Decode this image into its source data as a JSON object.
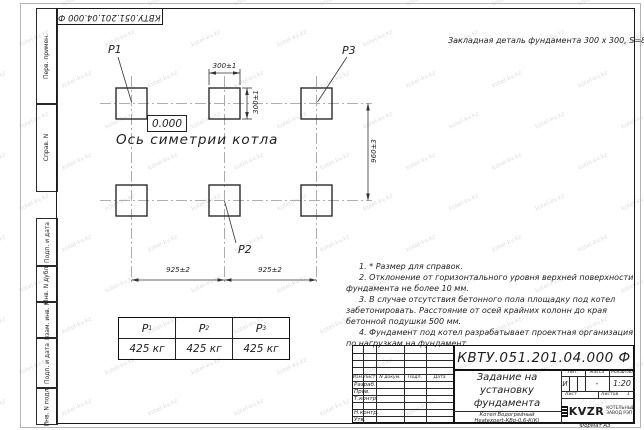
{
  "watermark": {
    "text": "kotel-kv.kz"
  },
  "stamp_top": {
    "designation": "КВТУ.051.201.04.000  Ф"
  },
  "top_note": "Закладная деталь фундамента  300 x 300,  S=8;",
  "drawing": {
    "elevation": "0.000",
    "axis_label": "Ось симетрии котла",
    "point_labels": {
      "p1": "P1",
      "p2": "P2",
      "p3": "P3"
    },
    "dims": {
      "width_top": "300±1",
      "height_side": "300±1",
      "row_spacing": "960±3",
      "col_spacing_left": "925±2",
      "col_spacing_right": "925±2"
    }
  },
  "notes": [
    "1. * Размер для справок.",
    "2. Отклонение от горизонтального уровня верхней поверхности фундамента не более 10 мм.",
    "3. В случае отсутствия бетонного пола площадку под котел забетонировать. Расстояние от осей крайних колонн до края бетонной подушки 500 мм.",
    "4. Фундамент под котел разрабатывает проектная организация по нагрузкам на фундамент."
  ],
  "load_table": {
    "columns": [
      {
        "label": "P",
        "sub": "1",
        "value": "425 кг"
      },
      {
        "label": "P",
        "sub": "2",
        "value": "425 кг"
      },
      {
        "label": "P",
        "sub": "3",
        "value": "425 кг"
      }
    ]
  },
  "sidebar": {
    "labels": [
      "Перв. примен.",
      "Справ. N",
      "Подп. и дата",
      "Инв. N дубл.",
      "Взам. инв. N",
      "Подп. и дата",
      "Инв. N подл."
    ]
  },
  "title_block": {
    "designation": "КВТУ.051.201.04.000  Ф",
    "title": "Задание на установку фундамента",
    "doc_header": {
      "izm": "Изм.",
      "list": "Лист",
      "ndoc": "N докум.",
      "podp": "Подп.",
      "data": "Дата"
    },
    "sign_rows": [
      "Разраб.",
      "Пров.",
      "Т.контр.",
      "",
      "Н.контр.",
      "Утв."
    ],
    "lit_header": "Лит.",
    "lit_value": "И",
    "mass_header": "Масса",
    "mass_value": "-",
    "scale_header": "Масштаб",
    "scale_value": "1:20",
    "sheet_label": "Лист",
    "sheets_label": "Листов",
    "sheets_value": "1",
    "product_line1": "Котел Водогрейный",
    "product_line2": "Heatexpert-КВр-0,6-К(К)",
    "logo_text": "KVZR",
    "company_line1": "КОТЕЛЬНЫЙ",
    "company_line2": "ЗАВОД РЭП",
    "format_label": "Формат А3"
  }
}
